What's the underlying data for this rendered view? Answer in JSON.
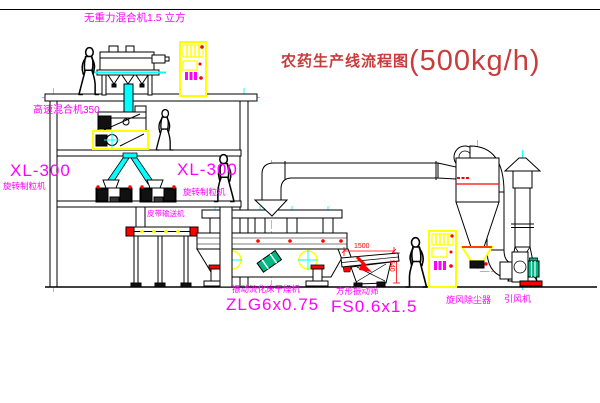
{
  "title": {
    "name": "农药生产线流程图",
    "capacity": "(500kg/h)"
  },
  "equipment_labels": {
    "gravityless_mixer": "无重力混合机1.5 立方",
    "high_speed_mixer": "高速混合机350",
    "granulator_left_model": "XL-300",
    "granulator_left_name": "旋转制粒机",
    "granulator_right_model": "XL-300",
    "granulator_right_name": "旋转制粒机",
    "belt_conveyor": "皮带输送机",
    "fluidbed_dryer_name": "振动流化床干燥机",
    "fluidbed_dryer_model": "ZLG6x0.75",
    "vibrating_screen_name": "方形振动筛",
    "vibrating_screen_model": "FS0.6x1.5",
    "cyclone": "旋风除尘器",
    "induced_draft_fan": "引风机"
  },
  "dimensions": {
    "screen_length": "1500",
    "screen_height": "540"
  },
  "colors": {
    "label_magenta": "#ff00ff",
    "title_red": "#c83c3c",
    "dimension_red": "#ff0000",
    "centerline_cyan": "#00ffff",
    "equipment_yellow": "#ffff00",
    "motor_green": "#00b884",
    "line_black": "#000000"
  }
}
